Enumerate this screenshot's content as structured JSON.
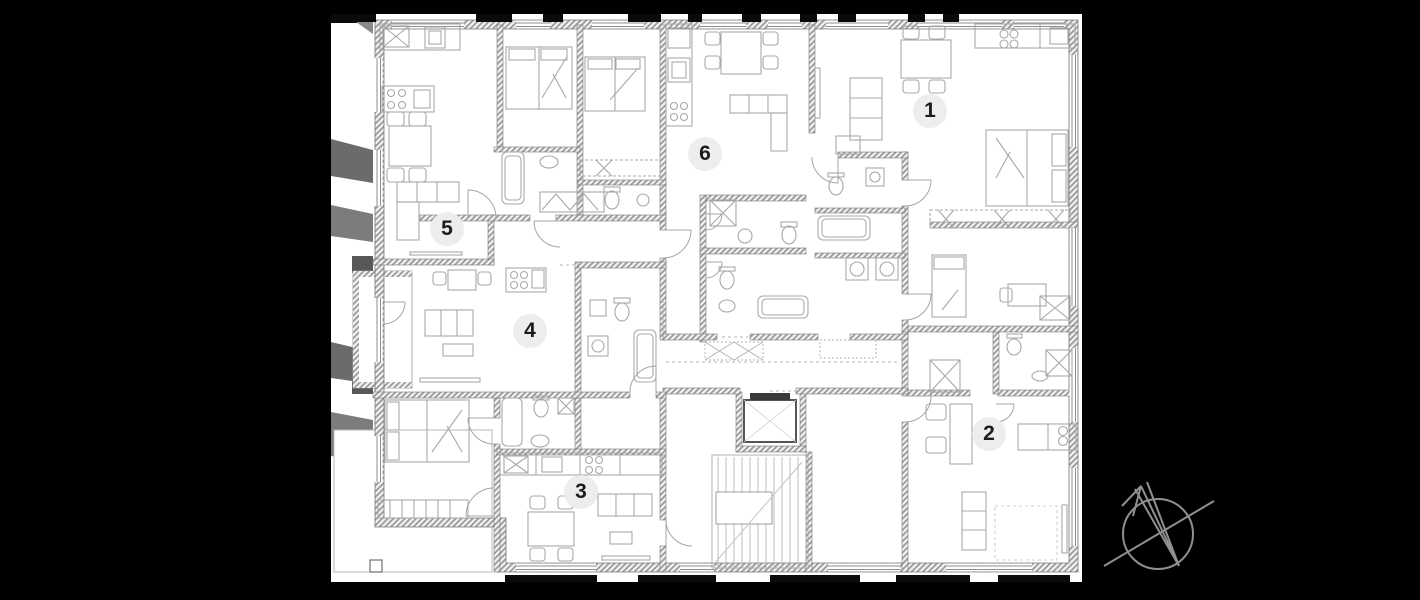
{
  "scene": {
    "type": "architectural-floor-plan",
    "floor_units_count": 6,
    "colors": {
      "background": "#000000",
      "paper": "#ffffff",
      "wall": "#8a8a8a",
      "furniture_line": "#a8a8a8",
      "badge_fill": "#ededed",
      "badge_text": "#1c1c1c",
      "compass_stroke": "#909090"
    }
  },
  "units": [
    {
      "id": "unit-1",
      "label": "1"
    },
    {
      "id": "unit-2",
      "label": "2"
    },
    {
      "id": "unit-3",
      "label": "3"
    },
    {
      "id": "unit-4",
      "label": "4"
    },
    {
      "id": "unit-5",
      "label": "5"
    },
    {
      "id": "unit-6",
      "label": "6"
    }
  ],
  "icons": [
    {
      "name": "north-compass-icon"
    }
  ]
}
